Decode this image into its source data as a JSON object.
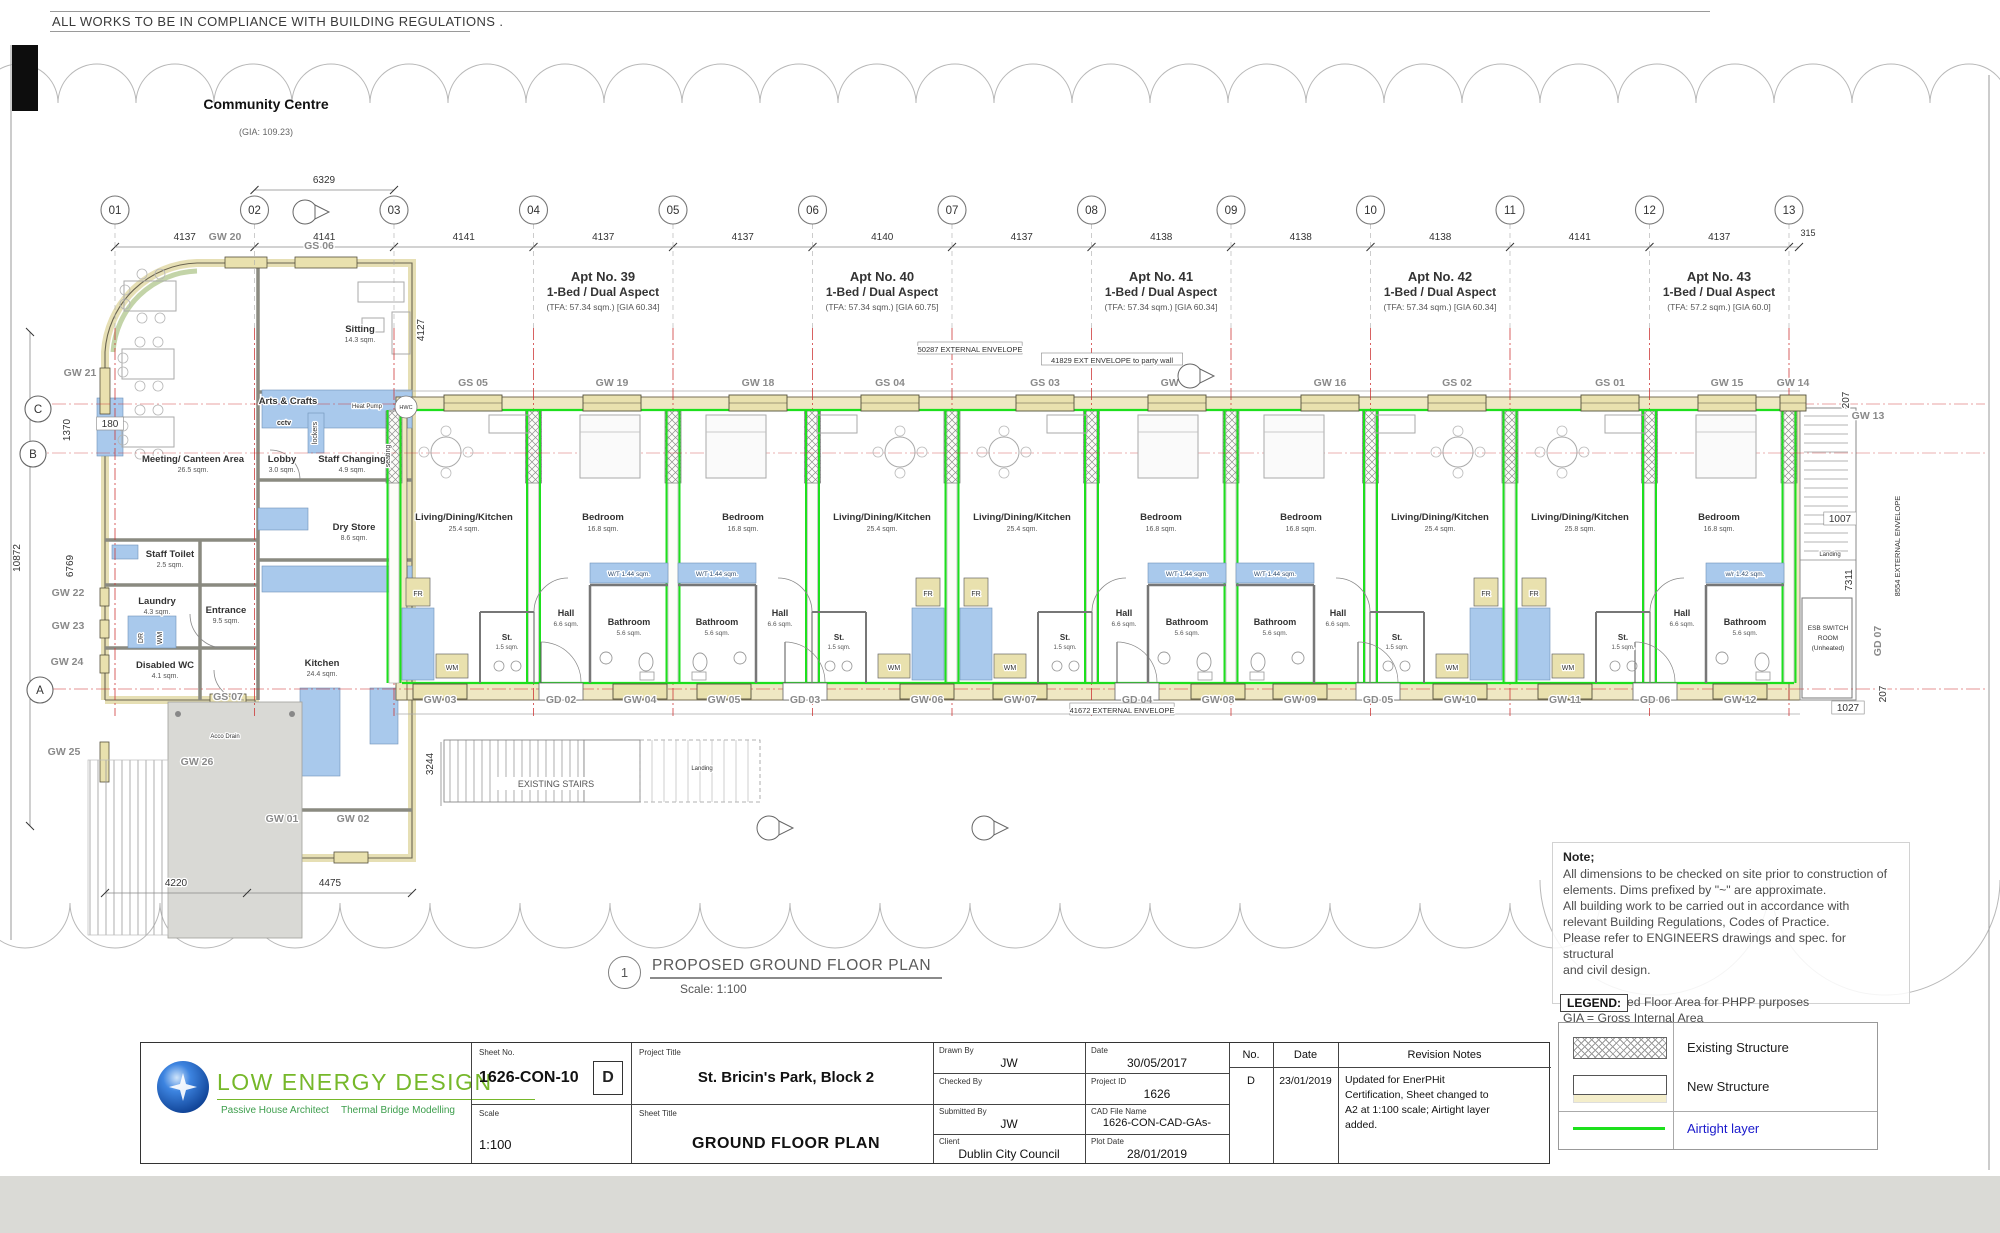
{
  "sheet": {
    "top_note": "ALL WORKS TO BE IN COMPLIANCE WITH BUILDING REGULATIONS .",
    "plan_title": "PROPOSED GROUND FLOOR PLAN",
    "plan_scale": "Scale: 1:100",
    "plan_circle": "1"
  },
  "community_centre": {
    "title": "Community Centre",
    "gia": "(GIA: 109.23)",
    "rooms": [
      {
        "label": "Sitting",
        "area": "14.3 sqm.",
        "x": 360,
        "y": 332
      },
      {
        "label": "Arts & Crafts",
        "area": "",
        "x": 288,
        "y": 404
      },
      {
        "label": "Meeting/ Canteen Area",
        "area": "26.5 sqm.",
        "x": 193,
        "y": 462
      },
      {
        "label": "Lobby",
        "area": "3.0 sqm.",
        "x": 282,
        "y": 462
      },
      {
        "label": "Staff Changing",
        "area": "4.9 sqm.",
        "x": 352,
        "y": 462
      },
      {
        "label": "Dry Store",
        "area": "8.6 sqm.",
        "x": 354,
        "y": 530
      },
      {
        "label": "Staff Toilet",
        "area": "2.5 sqm.",
        "x": 170,
        "y": 557
      },
      {
        "label": "Laundry",
        "area": "4.3 sqm.",
        "x": 157,
        "y": 604
      },
      {
        "label": "Entrance",
        "area": "9.5 sqm.",
        "x": 226,
        "y": 613
      },
      {
        "label": "Disabled WC",
        "area": "4.1 sqm.",
        "x": 165,
        "y": 668
      },
      {
        "label": "Kitchen",
        "area": "24.4 sqm.",
        "x": 322,
        "y": 666
      }
    ],
    "small_labels": [
      {
        "t": "cctv",
        "x": 284,
        "y": 425,
        "w": "bold"
      },
      {
        "t": "lockers",
        "x": 317,
        "y": 433,
        "r": -90
      },
      {
        "t": "seating",
        "x": 390,
        "y": 456,
        "r": -90
      },
      {
        "t": "Heat Pump",
        "x": 367,
        "y": 408,
        "s": 6
      },
      {
        "t": "HWC",
        "x": 406,
        "y": 409,
        "s": 5.5,
        "circ": true
      },
      {
        "t": "DR",
        "x": 143,
        "y": 638,
        "r": -90
      },
      {
        "t": "WM",
        "x": 162,
        "y": 638,
        "r": -90
      },
      {
        "t": "Acco Drain",
        "x": 225,
        "y": 738,
        "s": 6
      },
      {
        "t": "Landing",
        "x": 702,
        "y": 770,
        "s": 6
      },
      {
        "t": "Landing",
        "x": 1830,
        "y": 556,
        "s": 6
      }
    ]
  },
  "grid": {
    "bubbles": [
      "01",
      "02",
      "03",
      "04",
      "05",
      "06",
      "07",
      "08",
      "09",
      "10",
      "11",
      "12",
      "13"
    ],
    "dims": [
      "4137",
      "4141",
      "4141",
      "4137",
      "4137",
      "4140",
      "4137",
      "4138",
      "4138",
      "4138",
      "4141",
      "4137"
    ],
    "end_dim": "315",
    "top_dim": "6329"
  },
  "apartments": [
    {
      "no": "Apt No. 39",
      "type": "1-Bed / Dual Aspect",
      "area": "(TFA: 57.34 sqm.) [GIA 60.34]",
      "ldk": "Living/Dining/Kitchen",
      "ldk_area": "25.4 sqm.",
      "bed": "Bedroom",
      "bed_area": "16.8 sqm.",
      "hall": "Hall",
      "hall_area": "6.6 sqm.",
      "bath": "Bathroom",
      "bath_area": "5.6 sqm.",
      "st": "St.",
      "st_area": "1.5 sqm.",
      "strip": "W/T 1.44 sqm.",
      "fr": "FR",
      "wm": "WM"
    },
    {
      "no": "Apt No. 40",
      "type": "1-Bed / Dual Aspect",
      "area": "(TFA: 57.34 sqm.) [GIA 60.75]",
      "ldk": "Living/Dining/Kitchen",
      "ldk_area": "25.4 sqm.",
      "bed": "Bedroom",
      "bed_area": "16.8 sqm.",
      "hall": "Hall",
      "hall_area": "6.6 sqm.",
      "bath": "Bathroom",
      "bath_area": "5.6 sqm.",
      "st": "St.",
      "st_area": "1.5 sqm.",
      "strip": "W/T 1.44 sqm.",
      "fr": "FR",
      "wm": "WM"
    },
    {
      "no": "Apt No. 41",
      "type": "1-Bed / Dual Aspect",
      "area": "(TFA: 57.34 sqm.) [GIA 60.34]",
      "ldk": "Living/Dining/Kitchen",
      "ldk_area": "25.4 sqm.",
      "bed": "Bedroom",
      "bed_area": "16.8 sqm.",
      "hall": "Hall",
      "hall_area": "6.6 sqm.",
      "bath": "Bathroom",
      "bath_area": "5.6 sqm.",
      "st": "St.",
      "st_area": "1.5 sqm.",
      "strip": "W/T 1.44 sqm.",
      "fr": "FR",
      "wm": "WM"
    },
    {
      "no": "Apt No. 42",
      "type": "1-Bed / Dual Aspect",
      "area": "(TFA: 57.34 sqm.) [GIA 60.34]",
      "ldk": "Living/Dining/Kitchen",
      "ldk_area": "25.4 sqm.",
      "bed": "Bedroom",
      "bed_area": "16.8 sqm.",
      "hall": "Hall",
      "hall_area": "6.6 sqm.",
      "bath": "Bathroom",
      "bath_area": "5.6 sqm.",
      "st": "St.",
      "st_area": "1.5 sqm.",
      "strip": "W/T 1.44 sqm.",
      "fr": "FR",
      "wm": "WM"
    },
    {
      "no": "Apt No. 43",
      "type": "1-Bed / Dual Aspect",
      "area": "(TFA: 57.2 sqm.) [GIA 60.0]",
      "ldk": "Living/Dining/Kitchen",
      "ldk_area": "25.8 sqm.",
      "bed": "Bedroom",
      "bed_area": "16.8 sqm.",
      "hall": "Hall",
      "hall_area": "6.6 sqm.",
      "bath": "Bathroom",
      "bath_area": "5.6 sqm.",
      "st": "St.",
      "st_area": "1.5 sqm.",
      "strip": "w/r 1.42 sqm.",
      "fr": "FR",
      "wm": "WM"
    }
  ],
  "openings_top": [
    "GS 05",
    "GW 19",
    "GW 18",
    "GS 04",
    "GS 03",
    "GW 17",
    "GW 16",
    "GS 02",
    "GS 01",
    "GW 15",
    "GW 14"
  ],
  "openings_bott": [
    "GW 03",
    "GD 02",
    "GW 04",
    "GW 05",
    "GD 03",
    "GW 06",
    "GW 07",
    "GD 04",
    "GW 08",
    "GW 09",
    "GD 05",
    "GW 10",
    "GW 11",
    "GD 06",
    "GW 12"
  ],
  "openings_misc": [
    {
      "t": "GW 20",
      "x": 225,
      "y": 240
    },
    {
      "t": "GS 06",
      "x": 319,
      "y": 249
    },
    {
      "t": "GW 21",
      "x": 80,
      "y": 376
    },
    {
      "t": "GW 22",
      "x": 68,
      "y": 596
    },
    {
      "t": "GW 23",
      "x": 68,
      "y": 629
    },
    {
      "t": "GW 24",
      "x": 67,
      "y": 665
    },
    {
      "t": "GW 25",
      "x": 64,
      "y": 755
    },
    {
      "t": "GW 26",
      "x": 197,
      "y": 765
    },
    {
      "t": "GS 07",
      "x": 228,
      "y": 700
    },
    {
      "t": "GW 01",
      "x": 282,
      "y": 822
    },
    {
      "t": "GW 02",
      "x": 353,
      "y": 822
    },
    {
      "t": "GW 13",
      "x": 1868,
      "y": 419
    },
    {
      "t": "GD 07",
      "x": 1881,
      "y": 641,
      "r": -90
    }
  ],
  "dim_labels": [
    {
      "t": "6329",
      "x": 324,
      "y": 183
    },
    {
      "t": "315",
      "x": 1808,
      "y": 236,
      "s": 9
    },
    {
      "t": "4127",
      "x": 424,
      "y": 330,
      "r": -90
    },
    {
      "t": "180",
      "x": 110,
      "y": 427,
      "box": true
    },
    {
      "t": "1370",
      "x": 70,
      "y": 430,
      "r": -90
    },
    {
      "t": "6769",
      "x": 73,
      "y": 566,
      "r": -90
    },
    {
      "t": "10872",
      "x": 20,
      "y": 558,
      "r": -90
    },
    {
      "t": "3244",
      "x": 433,
      "y": 764,
      "r": -90
    },
    {
      "t": "4220",
      "x": 176,
      "y": 886
    },
    {
      "t": "4475",
      "x": 330,
      "y": 886
    },
    {
      "t": "207",
      "x": 1849,
      "y": 400,
      "r": -90
    },
    {
      "t": "1007",
      "x": 1840,
      "y": 522,
      "box": true
    },
    {
      "t": "7311",
      "x": 1852,
      "y": 580,
      "r": -90
    },
    {
      "t": "207",
      "x": 1886,
      "y": 694,
      "r": -90
    },
    {
      "t": "1027",
      "x": 1848,
      "y": 711,
      "box": true
    }
  ],
  "envelopes": [
    {
      "t": "50287 EXTERNAL ENVELOPE",
      "x": 970,
      "y": 351
    },
    {
      "t": "41829 EXT ENVELOPE to party wall",
      "x": 1112,
      "y": 362
    },
    {
      "t": "41672 EXTERNAL ENVELOPE",
      "x": 1122,
      "y": 712
    },
    {
      "t": "8554 EXTERNAL ENVELOPE",
      "x": 1900,
      "y": 545,
      "r": -90
    }
  ],
  "row_markers": [
    {
      "t": "C",
      "x": 38,
      "y": 409
    },
    {
      "t": "B",
      "x": 33,
      "y": 454
    },
    {
      "t": "A",
      "x": 40,
      "y": 690
    }
  ],
  "stairs": {
    "existing": "EXISTING STAIRS"
  },
  "esb_room": [
    "ESB SWITCH",
    "ROOM",
    "(Unheated)"
  ],
  "note": {
    "heading": "Note;",
    "lines": [
      "All dimensions to be checked on site prior to construction of",
      "elements. Dims prefixed by \"~\" are approximate.",
      "All building work to be carried out in accordance with",
      "relevant Building Regulations, Codes of Practice.",
      "Please refer to ENGINEERS drawings and spec. for structural",
      "and civil design.",
      "",
      "TFA = Treated Floor Area for PHPP purposes",
      "GIA = Gross Internal Area"
    ]
  },
  "legend": {
    "title": "LEGEND:",
    "items": [
      {
        "label": "Existing Structure",
        "swatch": "hatch"
      },
      {
        "label": "New Structure",
        "swatch": "plain"
      },
      {
        "label": "Airtight layer",
        "swatch": "line"
      }
    ]
  },
  "title_block": {
    "sheet_no_label": "Sheet No.",
    "sheet_no": "1626-CON-10",
    "revision": "D",
    "project_title_label": "Project Title",
    "project_title": "St. Bricin's Park, Block 2",
    "scale_label": "Scale",
    "scale": "1:100",
    "sheet_title_label": "Sheet Title",
    "sheet_title": "GROUND FLOOR PLAN",
    "drawn_by_label": "Drawn By",
    "drawn_by": "JW",
    "date_label": "Date",
    "date": "30/05/2017",
    "checked_by_label": "Checked By",
    "checked_by": "",
    "project_id_label": "Project ID",
    "project_id": "1626",
    "submitted_by_label": "Submitted By",
    "submitted_by": "JW",
    "cad_file_label": "CAD File Name",
    "cad_file": "1626-CON-CAD-GAs-",
    "client_label": "Client",
    "client": "Dublin City Council",
    "plot_date_label": "Plot Date",
    "plot_date": "28/01/2019",
    "rev_no_label": "No.",
    "rev_date_label": "Date",
    "rev_notes_label": "Revision Notes",
    "rev_no": "D",
    "rev_date": "23/01/2019",
    "rev_notes_lines": [
      "Updated for EnerPHit",
      "Certification, Sheet changed to",
      "A2 at 1:100 scale; Airtight layer",
      "added."
    ]
  },
  "logo": {
    "name": "LOW ENERGY DESIGN",
    "sub1": "Passive House Architect",
    "sub2": "Thermal Bridge Modelling"
  },
  "colors": {
    "airtight": "#1de01d",
    "wall_fill": "#efe8c3",
    "window_fill": "#e9e1ae",
    "fixture": "#a9c9ec",
    "grid_red": "#cc3333",
    "label_gray": "#8a8a8a"
  }
}
